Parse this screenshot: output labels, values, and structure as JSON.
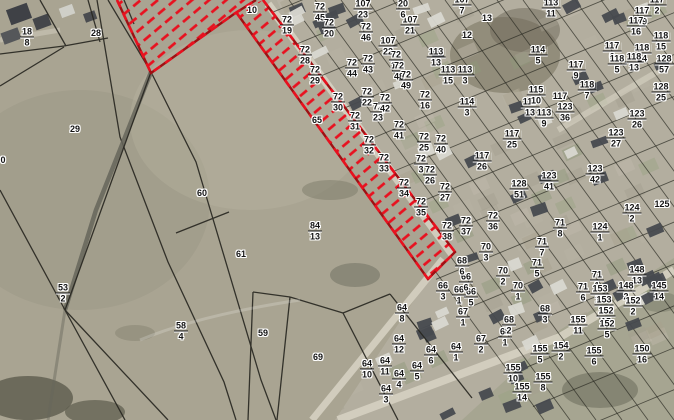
{
  "map": {
    "title": "cadastral-parcel-map-aerial",
    "colors": {
      "selection_red": "#e8111f",
      "selection_dark_red": "#9e1013",
      "boundary_black": "#26251f",
      "label_text": "#141414",
      "label_halo": "#ffffff",
      "field": "#a9a492",
      "built_area": "#b3ae9f",
      "road": "#d6d1c2"
    },
    "labels": [
      {
        "t": "18/8",
        "x": 27,
        "y": 37
      },
      {
        "t": "28",
        "x": 96,
        "y": 33
      },
      {
        "t": "29",
        "x": 75,
        "y": 129
      },
      {
        "t": "0",
        "x": 3,
        "y": 160
      },
      {
        "t": "60",
        "x": 202,
        "y": 193
      },
      {
        "t": "61",
        "x": 241,
        "y": 254
      },
      {
        "t": "53/2",
        "x": 63,
        "y": 293
      },
      {
        "t": "58/4",
        "x": 181,
        "y": 331
      },
      {
        "t": "59",
        "x": 263,
        "y": 333
      },
      {
        "t": "84/13",
        "x": 315,
        "y": 231
      },
      {
        "t": "65",
        "x": 317,
        "y": 120
      },
      {
        "t": "69",
        "x": 318,
        "y": 357
      },
      {
        "t": "10",
        "x": 252,
        "y": 10
      },
      {
        "t": "72/19",
        "x": 287,
        "y": 25
      },
      {
        "t": "72/45",
        "x": 320,
        "y": 12
      },
      {
        "t": "72/20",
        "x": 329,
        "y": 28
      },
      {
        "t": "72/28",
        "x": 305,
        "y": 55
      },
      {
        "t": "72/29",
        "x": 315,
        "y": 75
      },
      {
        "t": "72/30",
        "x": 338,
        "y": 102
      },
      {
        "t": "72/31",
        "x": 355,
        "y": 121
      },
      {
        "t": "72/32",
        "x": 369,
        "y": 145
      },
      {
        "t": "72/33",
        "x": 384,
        "y": 163
      },
      {
        "t": "72/34",
        "x": 404,
        "y": 188
      },
      {
        "t": "72/35",
        "x": 421,
        "y": 207
      },
      {
        "t": "72/22",
        "x": 367,
        "y": 97
      },
      {
        "t": "72/23",
        "x": 378,
        "y": 112
      },
      {
        "t": "72/42",
        "x": 385,
        "y": 103
      },
      {
        "t": "72/44",
        "x": 352,
        "y": 68
      },
      {
        "t": "72/43",
        "x": 368,
        "y": 64
      },
      {
        "t": "72/46",
        "x": 366,
        "y": 32
      },
      {
        "t": "107/22",
        "x": 388,
        "y": 46
      },
      {
        "t": "72/13",
        "x": 396,
        "y": 60
      },
      {
        "t": "72/48",
        "x": 399,
        "y": 71
      },
      {
        "t": "72/49",
        "x": 406,
        "y": 80
      },
      {
        "t": "107/21",
        "x": 410,
        "y": 25
      },
      {
        "t": "20/6",
        "x": 403,
        "y": 9
      },
      {
        "t": "107/23",
        "x": 363,
        "y": 9
      },
      {
        "t": "72/25",
        "x": 424,
        "y": 142
      },
      {
        "t": "72/40",
        "x": 441,
        "y": 144
      },
      {
        "t": "72/41",
        "x": 399,
        "y": 130
      },
      {
        "t": "72/3",
        "x": 421,
        "y": 164
      },
      {
        "t": "72/26",
        "x": 430,
        "y": 175
      },
      {
        "t": "72/27",
        "x": 445,
        "y": 192
      },
      {
        "t": "72/16",
        "x": 425,
        "y": 100
      },
      {
        "t": "72/36",
        "x": 493,
        "y": 221
      },
      {
        "t": "72/37",
        "x": 466,
        "y": 226
      },
      {
        "t": "72/38",
        "x": 447,
        "y": 231
      },
      {
        "t": "117/26",
        "x": 482,
        "y": 161
      },
      {
        "t": "117/25",
        "x": 512,
        "y": 139
      },
      {
        "t": "117/13",
        "x": 530,
        "y": 107
      },
      {
        "t": "113/9",
        "x": 544,
        "y": 118
      },
      {
        "t": "114/3",
        "x": 467,
        "y": 107
      },
      {
        "t": "107/7",
        "x": 462,
        "y": 5
      },
      {
        "t": "13",
        "x": 487,
        "y": 18
      },
      {
        "t": "12",
        "x": 467,
        "y": 35
      },
      {
        "t": "113/13",
        "x": 436,
        "y": 57
      },
      {
        "t": "113/15",
        "x": 448,
        "y": 75
      },
      {
        "t": "113/3",
        "x": 465,
        "y": 75
      },
      {
        "t": "113/11",
        "x": 551,
        "y": 8
      },
      {
        "t": "114/5",
        "x": 538,
        "y": 55
      },
      {
        "t": "115/10",
        "x": 536,
        "y": 95
      },
      {
        "t": "117",
        "x": 560,
        "y": 96
      },
      {
        "t": "117/2",
        "x": 657,
        "y": 5
      },
      {
        "t": "117/49",
        "x": 642,
        "y": 16
      },
      {
        "t": "117/16",
        "x": 636,
        "y": 26
      },
      {
        "t": "118/15",
        "x": 661,
        "y": 41
      },
      {
        "t": "117/6",
        "x": 612,
        "y": 51
      },
      {
        "t": "118/14",
        "x": 642,
        "y": 53
      },
      {
        "t": "118/13",
        "x": 634,
        "y": 62
      },
      {
        "t": "128/57",
        "x": 664,
        "y": 64
      },
      {
        "t": "118/5",
        "x": 617,
        "y": 64
      },
      {
        "t": "117/9",
        "x": 576,
        "y": 70
      },
      {
        "t": "118/7",
        "x": 587,
        "y": 90
      },
      {
        "t": "128/25",
        "x": 661,
        "y": 92
      },
      {
        "t": "123/36",
        "x": 565,
        "y": 112
      },
      {
        "t": "123/26",
        "x": 637,
        "y": 119
      },
      {
        "t": "123/27",
        "x": 616,
        "y": 138
      },
      {
        "t": "123/42",
        "x": 595,
        "y": 174
      },
      {
        "t": "123/41",
        "x": 549,
        "y": 181
      },
      {
        "t": "128/51",
        "x": 519,
        "y": 189
      },
      {
        "t": "125",
        "x": 662,
        "y": 204
      },
      {
        "t": "124/2",
        "x": 632,
        "y": 213
      },
      {
        "t": "124/1",
        "x": 600,
        "y": 232
      },
      {
        "t": "66/3",
        "x": 443,
        "y": 291
      },
      {
        "t": "66/1",
        "x": 459,
        "y": 295
      },
      {
        "t": "66/5",
        "x": 471,
        "y": 297
      },
      {
        "t": "66/6",
        "x": 466,
        "y": 282
      },
      {
        "t": "67/1",
        "x": 463,
        "y": 317
      },
      {
        "t": "68/6",
        "x": 462,
        "y": 266
      },
      {
        "t": "70/3",
        "x": 486,
        "y": 252
      },
      {
        "t": "70/2",
        "x": 503,
        "y": 276
      },
      {
        "t": "70/1",
        "x": 518,
        "y": 291
      },
      {
        "t": "71/7",
        "x": 542,
        "y": 247
      },
      {
        "t": "71/5",
        "x": 537,
        "y": 268
      },
      {
        "t": "71/8",
        "x": 560,
        "y": 228
      },
      {
        "t": "71/1",
        "x": 597,
        "y": 280
      },
      {
        "t": "148/13",
        "x": 637,
        "y": 275
      },
      {
        "t": "148/2",
        "x": 626,
        "y": 291
      },
      {
        "t": "145/14",
        "x": 659,
        "y": 291
      },
      {
        "t": "71/6",
        "x": 583,
        "y": 292
      },
      {
        "t": "153/16",
        "x": 600,
        "y": 294
      },
      {
        "t": "153/3",
        "x": 604,
        "y": 305
      },
      {
        "t": "152/2",
        "x": 633,
        "y": 306
      },
      {
        "t": "152/15",
        "x": 606,
        "y": 316
      },
      {
        "t": "152/5",
        "x": 607,
        "y": 329
      },
      {
        "t": "155/11",
        "x": 578,
        "y": 325
      },
      {
        "t": "154/2",
        "x": 561,
        "y": 351
      },
      {
        "t": "155/6",
        "x": 594,
        "y": 356
      },
      {
        "t": "150/16",
        "x": 642,
        "y": 354
      },
      {
        "t": "64/8",
        "x": 402,
        "y": 313
      },
      {
        "t": "64/12",
        "x": 399,
        "y": 344
      },
      {
        "t": "64/6",
        "x": 431,
        "y": 355
      },
      {
        "t": "64/10",
        "x": 367,
        "y": 369
      },
      {
        "t": "64/11",
        "x": 385,
        "y": 366
      },
      {
        "t": "64/5",
        "x": 417,
        "y": 371
      },
      {
        "t": "64/4",
        "x": 399,
        "y": 379
      },
      {
        "t": "64/3",
        "x": 386,
        "y": 394
      },
      {
        "t": "64/1",
        "x": 456,
        "y": 352
      },
      {
        "t": "67/2",
        "x": 481,
        "y": 344
      },
      {
        "t": "68/1",
        "x": 505,
        "y": 337
      },
      {
        "t": "68/2",
        "x": 509,
        "y": 325
      },
      {
        "t": "68/3",
        "x": 545,
        "y": 314
      },
      {
        "t": "155/5",
        "x": 540,
        "y": 354
      },
      {
        "t": "155/10",
        "x": 513,
        "y": 373
      },
      {
        "t": "155/8",
        "x": 543,
        "y": 382
      },
      {
        "t": "155/14",
        "x": 522,
        "y": 392
      }
    ]
  }
}
